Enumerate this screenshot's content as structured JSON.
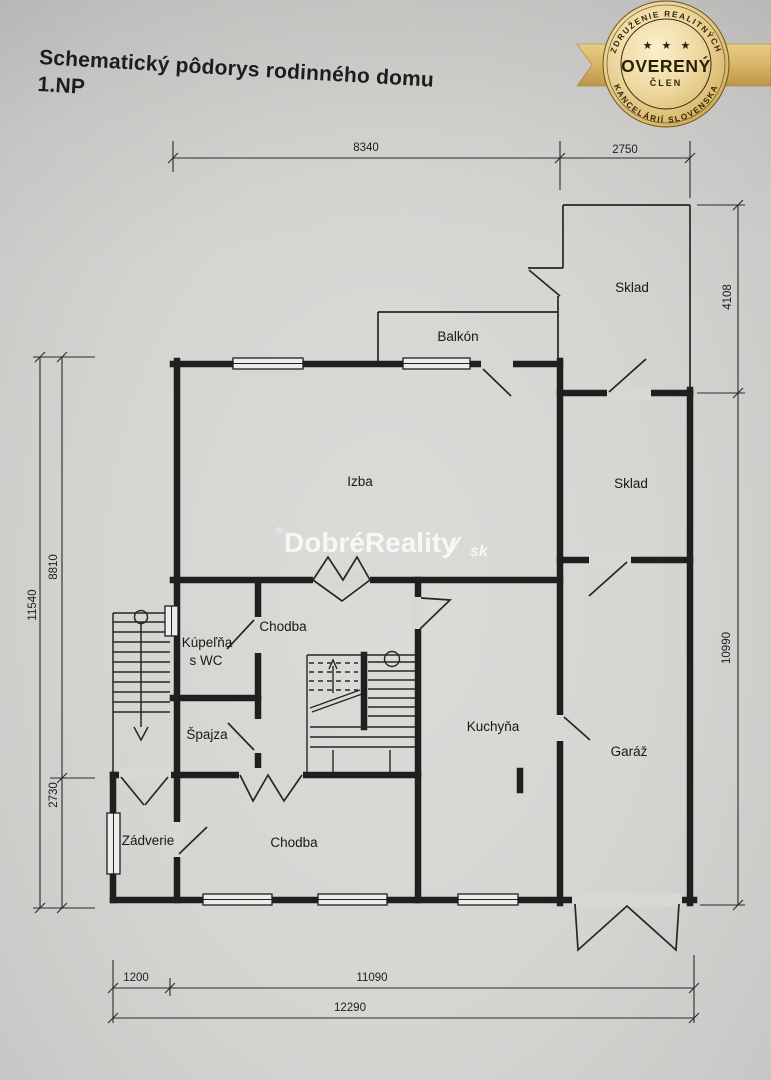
{
  "title": {
    "line1": "Schematický pôdorys rodinného domu",
    "line2": "1.NP"
  },
  "badge": {
    "arc_top": "ZDRUŽENIE REALITNÝCH",
    "arc_bottom": "KANCELÁRIÍ SLOVENSKA",
    "stars": "★ ★ ★",
    "main": "OVERENÝ",
    "sub": "ČLEN",
    "gold": "#d9b567",
    "gold_dark": "#b08a3c",
    "text_color": "#2f2408"
  },
  "watermark": {
    "reg": "®",
    "brand": "DobréReality",
    "slash": "∕",
    "tld": "sk"
  },
  "plan": {
    "line_color": "#1f1f1f",
    "paper_color": "#d8d7d4",
    "rooms": {
      "izba": "Izba",
      "balkon": "Balkón",
      "sklad_horny": "Sklad",
      "sklad_stredny": "Sklad",
      "garaz": "Garáž",
      "kuchyna": "Kuchyňa",
      "chodba_horna": "Chodba",
      "chodba_dolna": "Chodba",
      "kupelna_line1": "Kúpeľňa",
      "kupelna_line2": "s WC",
      "spajza": "Špajza",
      "zadverie": "Zádverie"
    },
    "dimensions": {
      "top_main": "8340",
      "top_right": "2750",
      "right_top": "4108",
      "right_bottom": "10990",
      "left_outer": "11540",
      "left_top": "8810",
      "left_bottom": "2730",
      "bottom_offset": "1200",
      "bottom_main": "11090",
      "bottom_total": "12290"
    }
  }
}
